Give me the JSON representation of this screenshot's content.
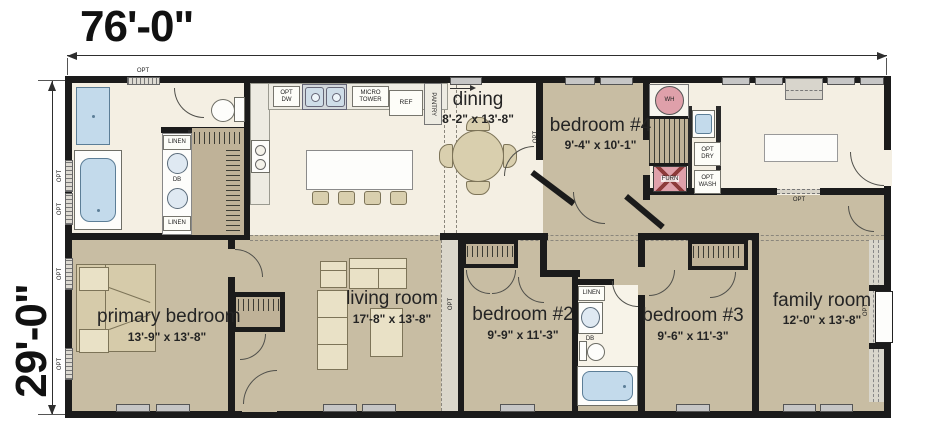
{
  "dimensions": {
    "width": "76'-0\"",
    "height": "29'-0\""
  },
  "rooms": {
    "dining": {
      "name": "dining",
      "dims": "8'-2\" x 13'-8\""
    },
    "bedroom4": {
      "name": "bedroom #4",
      "dims": "9'-4\" x 10'-1\""
    },
    "primary": {
      "name": "primary bedroom",
      "dims": "13'-9\" x 13'-8\""
    },
    "living": {
      "name": "living room",
      "dims": "17'-8\" x 13'-8\""
    },
    "bedroom2": {
      "name": "bedroom #2",
      "dims": "9'-9\" x 11'-3\""
    },
    "bedroom3": {
      "name": "bedroom #3",
      "dims": "9'-6\" x 11'-3\""
    },
    "family": {
      "name": "family room",
      "dims": "12'-0\" x 13'-8\""
    }
  },
  "labels": {
    "opt": "OPT",
    "opt_dw": "OPT\nDW",
    "micro_tower": "MICRO\nTOWER",
    "ref": "REF",
    "pantry": "PANTRY",
    "linen": "LINEN",
    "db": "DB",
    "wh": "WH",
    "furn": "FURN",
    "opt_dry": "OPT\nDRY",
    "opt_wash": "OPT\nWASH"
  },
  "colors": {
    "wall": "#1b1b1b",
    "floor_tan": "#c8bda3",
    "floor_cream": "#f4efe3",
    "closet_tan": "#bfb298",
    "fixture_blue": "#c3daeb",
    "symbol_pink": "#dfa0aa",
    "counter_gray": "#edebe2",
    "window_gray": "#c6c6c6"
  }
}
